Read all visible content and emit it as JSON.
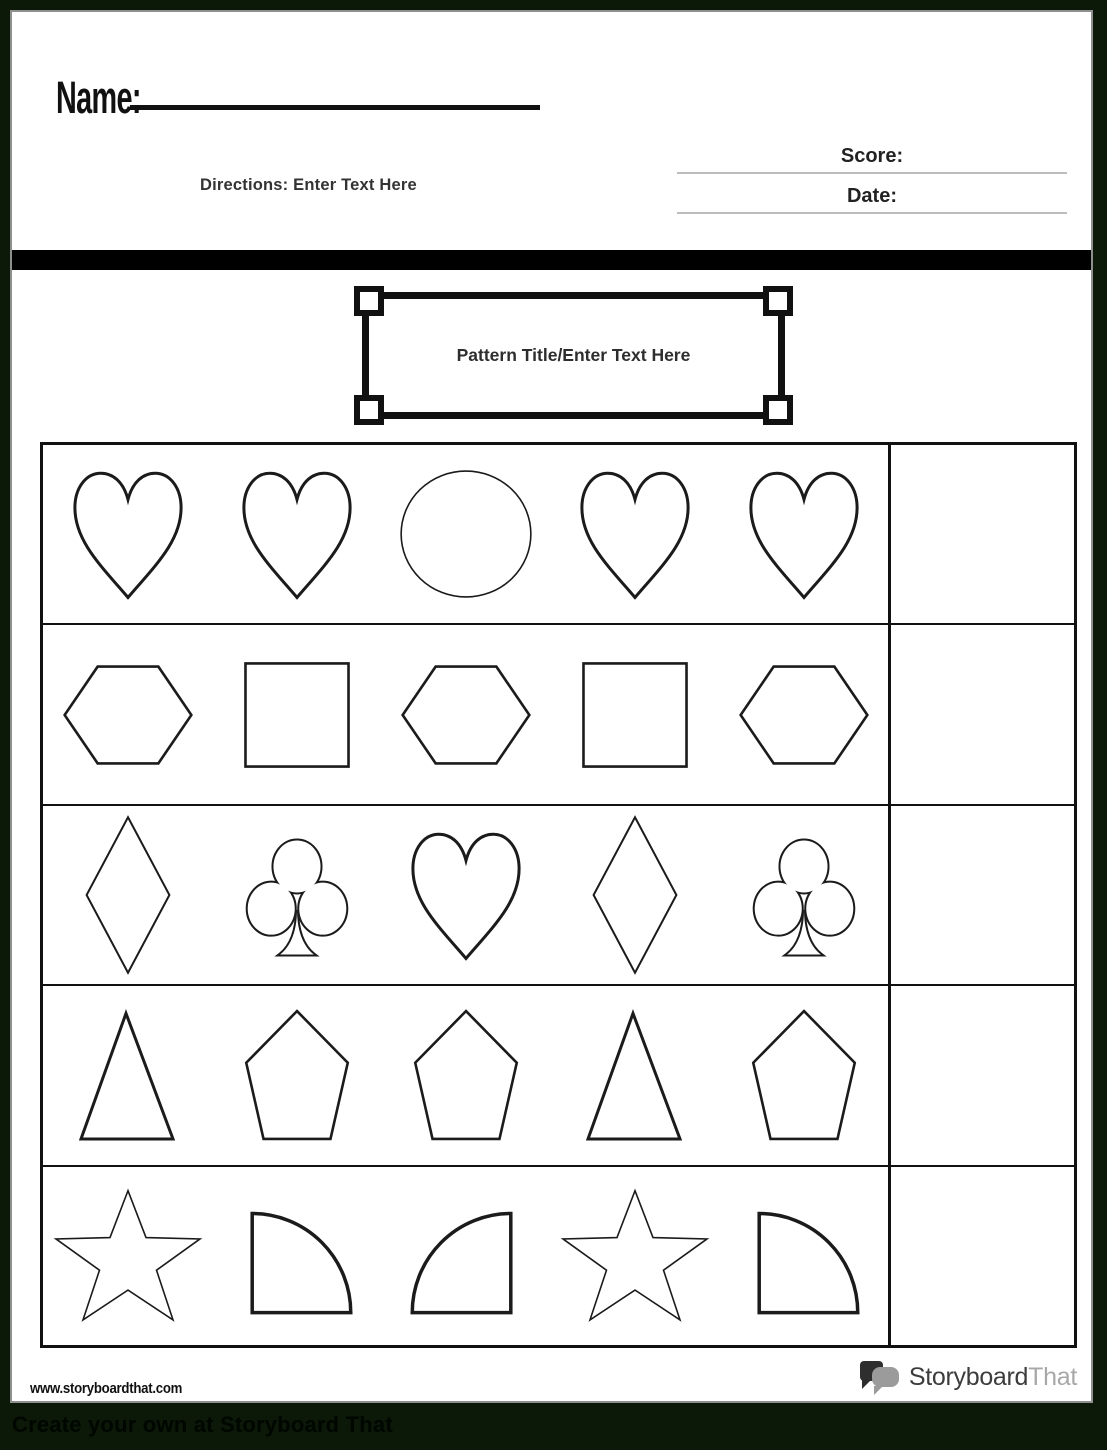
{
  "header": {
    "name_label": "Name:",
    "directions": "Directions: Enter Text Here",
    "score_label": "Score:",
    "date_label": "Date:",
    "pattern_title": "Pattern Title/Enter Text Here"
  },
  "grid": {
    "rows": [
      {
        "shapes": [
          "heart",
          "heart",
          "circle",
          "heart",
          "heart"
        ]
      },
      {
        "shapes": [
          "hexagon",
          "square",
          "hexagon",
          "square",
          "hexagon"
        ]
      },
      {
        "shapes": [
          "diamond",
          "club",
          "heart",
          "diamond",
          "club"
        ]
      },
      {
        "shapes": [
          "triangle",
          "pentagon",
          "pentagon",
          "triangle",
          "pentagon"
        ]
      },
      {
        "shapes": [
          "star",
          "quarter-circle",
          "quarter-circle-flipped",
          "star",
          "quarter-circle"
        ]
      }
    ],
    "answer_column_per_row": true
  },
  "footer": {
    "url": "www.storyboardthat.com",
    "logo_storyboard": "Storyboard",
    "logo_that": "That",
    "cta": "Create your own at Storyboard That"
  },
  "colors": {
    "page_background": "#ffffff",
    "surround_background": "#0c1808",
    "ink": "#111111",
    "divider_bar": "#000000",
    "fill_line_gray": "#bcbcbc",
    "logo_dark": "#2e2e2e",
    "logo_gray": "#9b9b9b"
  }
}
